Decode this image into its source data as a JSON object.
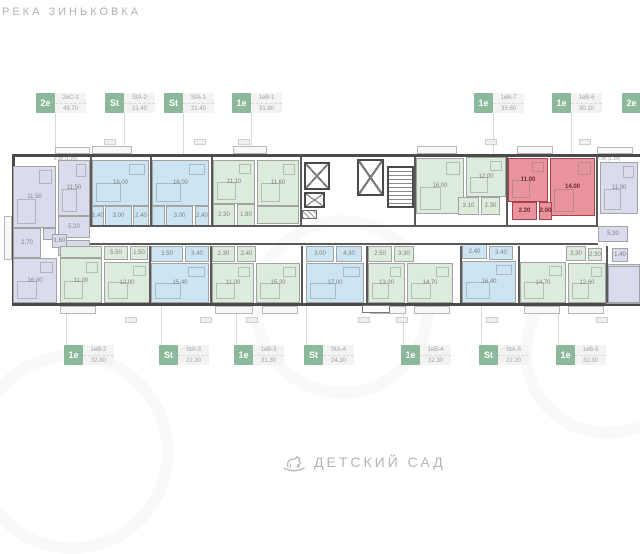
{
  "header": {
    "location_label": "РЕКА ЗИНЬКОВКА"
  },
  "footer": {
    "caption": "ДЕТСКИЙ САД",
    "icon": "rocking-horse-icon"
  },
  "colors": {
    "badge": "#8cb89b",
    "green": "#dcebdc",
    "blue": "#cde4f3",
    "purple": "#dbdbee",
    "red_fill": "#e9939d",
    "red_wall": "#a8434e",
    "wall": "#4a4a4a",
    "label_box": "#f3f3f1",
    "label_text": "#a0a0a0",
    "leader": "#d9d9d9"
  },
  "units_top": [
    {
      "type": "2е",
      "code": "2еС-1",
      "area": "49.70",
      "x": 36,
      "line_x": 55
    },
    {
      "type": "St",
      "code": "StA-2",
      "area": "21.40",
      "x": 105,
      "line_x": 124
    },
    {
      "type": "St",
      "code": "StA-1",
      "area": "21.40",
      "x": 164,
      "line_x": 183
    },
    {
      "type": "1е",
      "code": "1еВ-1",
      "area": "31.80",
      "x": 232,
      "line_x": 251
    },
    {
      "type": "1е",
      "code": "1еВ-7",
      "area": "33.60",
      "x": 474,
      "line_x": 493
    },
    {
      "type": "1е",
      "code": "1еВ-6",
      "area": "30.10",
      "x": 552,
      "line_x": 571
    },
    {
      "type": "2е",
      "code": "",
      "area": "",
      "x": 622,
      "line_x": null
    }
  ],
  "units_bottom": [
    {
      "type": "1е",
      "code": "1еВ-2",
      "area": "32.80",
      "x": 64,
      "line_x": 66
    },
    {
      "type": "St",
      "code": "StA-3",
      "area": "22.30",
      "x": 159,
      "line_x": 161
    },
    {
      "type": "1е",
      "code": "1еВ-3",
      "area": "31.30",
      "x": 234,
      "line_x": 236
    },
    {
      "type": "St",
      "code": "StA-4",
      "area": "24.30",
      "x": 304,
      "line_x": 306
    },
    {
      "type": "1е",
      "code": "1еВ-4",
      "area": "32.30",
      "x": 401,
      "line_x": 403
    },
    {
      "type": "St",
      "code": "StA-5",
      "area": "22.20",
      "x": 479,
      "line_x": 481
    },
    {
      "type": "1е",
      "code": "1еВ-5",
      "area": "32.30",
      "x": 556,
      "line_x": 558
    }
  ],
  "selected_unit": "1еВ-6",
  "plan": {
    "building": {
      "x": 12,
      "y": 154,
      "w": 640,
      "h": 152
    },
    "rooms": [
      [
        13,
        166,
        43,
        62,
        "purple",
        "11.50"
      ],
      [
        58,
        160,
        32,
        56,
        "purple",
        "11.50"
      ],
      [
        58,
        216,
        32,
        22,
        "purple",
        "5.20"
      ],
      [
        13,
        228,
        28,
        30,
        "purple",
        "2.70"
      ],
      [
        43,
        228,
        13,
        12,
        "purple",
        ""
      ],
      [
        58,
        240,
        32,
        16,
        "purple",
        ""
      ],
      [
        52,
        234,
        15,
        14,
        "purple",
        "1.60"
      ],
      [
        13,
        258,
        44,
        45,
        "purple",
        "16.00"
      ],
      [
        92,
        160,
        57,
        46,
        "blue",
        "16.00"
      ],
      [
        92,
        206,
        12,
        20,
        "blue",
        "1.40"
      ],
      [
        105,
        206,
        27,
        20,
        "blue",
        "3.00"
      ],
      [
        133,
        206,
        16,
        20,
        "blue",
        "2.40"
      ],
      [
        152,
        160,
        57,
        46,
        "blue",
        "16.00"
      ],
      [
        152,
        206,
        13,
        20,
        "blue",
        ""
      ],
      [
        166,
        206,
        27,
        20,
        "blue",
        "3.00"
      ],
      [
        195,
        206,
        14,
        20,
        "blue",
        "2.40"
      ],
      [
        213,
        160,
        42,
        44,
        "green",
        "11.10"
      ],
      [
        213,
        204,
        22,
        22,
        "green",
        "2.30"
      ],
      [
        237,
        204,
        18,
        22,
        "green",
        "1.80"
      ],
      [
        257,
        160,
        42,
        46,
        "green",
        "11.60"
      ],
      [
        257,
        206,
        42,
        18,
        "green",
        ""
      ],
      [
        416,
        158,
        48,
        56,
        "green",
        "16.00"
      ],
      [
        466,
        157,
        40,
        40,
        "green",
        "12.00"
      ],
      [
        458,
        197,
        21,
        18,
        "green",
        "3.10"
      ],
      [
        481,
        197,
        19,
        18,
        "green",
        "2.30"
      ],
      [
        508,
        158,
        40,
        44,
        "red",
        "11.00"
      ],
      [
        550,
        158,
        45,
        58,
        "red",
        "14.00"
      ],
      [
        512,
        202,
        25,
        18,
        "red",
        "2.20"
      ],
      [
        539,
        202,
        13,
        18,
        "red",
        "2.00"
      ],
      [
        600,
        162,
        38,
        52,
        "purple",
        "11.00"
      ],
      [
        598,
        226,
        30,
        16,
        "purple",
        "5.30"
      ],
      [
        612,
        248,
        16,
        14,
        "purple",
        "1.40"
      ],
      [
        606,
        264,
        34,
        40,
        "purple",
        ""
      ],
      [
        60,
        246,
        42,
        12,
        "green",
        ""
      ],
      [
        60,
        258,
        42,
        45,
        "green",
        "11.00"
      ],
      [
        104,
        262,
        46,
        41,
        "green",
        "12.00"
      ],
      [
        104,
        246,
        24,
        14,
        "green",
        "5.50"
      ],
      [
        130,
        246,
        18,
        14,
        "green",
        "1.50"
      ],
      [
        151,
        246,
        32,
        16,
        "blue",
        "3.50"
      ],
      [
        185,
        246,
        24,
        16,
        "blue",
        "3.40"
      ],
      [
        151,
        263,
        58,
        40,
        "blue",
        "15.40"
      ],
      [
        212,
        246,
        23,
        16,
        "green",
        "2.30"
      ],
      [
        237,
        246,
        19,
        16,
        "green",
        "2.40"
      ],
      [
        212,
        263,
        42,
        40,
        "green",
        "11.00"
      ],
      [
        256,
        263,
        44,
        40,
        "green",
        "15.20"
      ],
      [
        306,
        246,
        28,
        16,
        "blue",
        "3.00"
      ],
      [
        336,
        246,
        26,
        16,
        "blue",
        "4.30"
      ],
      [
        306,
        263,
        58,
        40,
        "blue",
        "17.00"
      ],
      [
        368,
        246,
        24,
        16,
        "green",
        "2.50"
      ],
      [
        394,
        246,
        20,
        16,
        "green",
        "3.30"
      ],
      [
        368,
        263,
        37,
        40,
        "green",
        "13.00"
      ],
      [
        407,
        263,
        46,
        40,
        "green",
        "14.70"
      ],
      [
        462,
        244,
        25,
        15,
        "blue",
        "2.40"
      ],
      [
        489,
        246,
        24,
        14,
        "blue",
        "3.40"
      ],
      [
        462,
        261,
        54,
        42,
        "blue",
        "16.40"
      ],
      [
        566,
        246,
        20,
        15,
        "green",
        "3.30"
      ],
      [
        588,
        248,
        14,
        13,
        "green",
        "2.30"
      ],
      [
        520,
        262,
        46,
        41,
        "green",
        "14.70"
      ],
      [
        568,
        263,
        38,
        40,
        "green",
        "12.60"
      ],
      [
        608,
        266,
        32,
        37,
        "purple",
        ""
      ]
    ],
    "elevators": [
      [
        304,
        162,
        26,
        28
      ],
      [
        304,
        192,
        21,
        16
      ],
      [
        357,
        159,
        27,
        37
      ]
    ],
    "stairs": [
      387,
      166,
      27,
      42
    ],
    "hatch": [
      302,
      210,
      15,
      9
    ],
    "corridor_walls": [
      [
        90,
        225,
        508,
        2
      ],
      [
        90,
        243,
        508,
        2
      ]
    ],
    "walls_top": [
      90,
      150,
      211,
      300,
      414,
      506,
      596
    ],
    "walls_bottom": [
      149,
      210,
      301,
      366,
      460,
      518,
      606
    ],
    "balconies_top": [
      [
        92,
        146,
        40,
        8
      ],
      [
        233,
        146,
        34,
        8
      ],
      [
        417,
        146,
        40,
        8
      ],
      [
        517,
        146,
        36,
        8
      ],
      [
        55,
        147,
        35,
        7
      ],
      [
        597,
        147,
        36,
        7
      ]
    ],
    "balconies_bottom": [
      [
        60,
        306,
        36,
        8
      ],
      [
        215,
        306,
        38,
        8
      ],
      [
        262,
        306,
        36,
        8
      ],
      [
        370,
        306,
        36,
        8
      ],
      [
        414,
        306,
        36,
        8
      ],
      [
        524,
        306,
        36,
        8
      ],
      [
        568,
        306,
        36,
        8
      ]
    ],
    "balcony_left": [
      4,
      216,
      8,
      44
    ],
    "balcony_notes": [
      {
        "text": "2.30 (1.20)",
        "x": 54,
        "y": 157
      },
      {
        "text": "2.30 (1.20)",
        "x": 597,
        "y": 157
      }
    ],
    "tags_top_y": 139,
    "tags_top_x": [
      104,
      194,
      238,
      485,
      579
    ],
    "tags_bottom_y": 317,
    "tags_bottom_x": [
      125,
      200,
      246,
      358,
      396,
      486,
      596
    ],
    "porch": [
      362,
      305,
      28,
      8
    ],
    "watermark_circles": [
      [
        -30,
        350,
        180
      ],
      [
        250,
        215,
        160
      ],
      [
        520,
        265,
        150
      ]
    ]
  }
}
